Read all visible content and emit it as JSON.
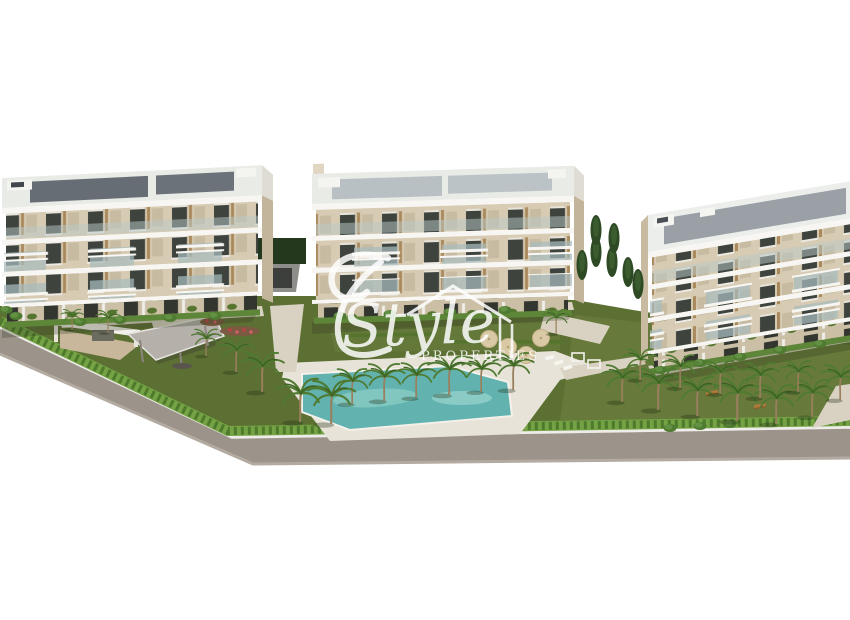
{
  "page": {
    "background": "#ffffff",
    "content_type": "aerial 3D architectural render of a new-build apartment complex with communal pool and palm gardens"
  },
  "watermark": {
    "script_word": "Style",
    "caps_word": "PROPERTIES",
    "house_icon": "house-outline-icon",
    "flourish_icon": "calligraphic-flourish-icon",
    "color": "#ffffff",
    "opacity": "0.85"
  },
  "scene": {
    "buildings": {
      "count": 3,
      "floors_each": 4,
      "style": "modern cream apartment blocks with white balconies and flat roofs"
    },
    "features": [
      "apartment-block-left",
      "apartment-block-center",
      "apartment-block-right",
      "swimming-pool",
      "pool-deck",
      "palm-trees",
      "lawn",
      "perimeter-hedge",
      "road",
      "entrance-gate",
      "parking-ramp",
      "pavilion",
      "sun-umbrellas",
      "sun-loungers",
      "benches",
      "cypress-trees",
      "flower-beds"
    ],
    "colors": {
      "wall_cream": "#d7cbb3",
      "wall_shade": "#c7bba2",
      "trim_white": "#f7f6f2",
      "window_dark": "#3e433d",
      "wood_accent": "#a9895b",
      "roof_panel_dark": "#676d74",
      "roof_panel_light": "#b9c0c4",
      "roof_panel_mid": "#9aa0a6",
      "grass": "#5d7034",
      "grass_light": "#6f8442",
      "hedge": "#74a244",
      "hedge_dark": "#4e7a2c",
      "palm_green": "#4f7a31",
      "palm_trunk": "#9a7f5e",
      "pool_water": "#62b3b0",
      "pool_light": "#a5dad5",
      "deck": "#e8e3d8",
      "path": "#d9d2c2",
      "road": "#9c948b",
      "road_edge": "#b3aba1",
      "curb": "#efede9",
      "umbrella_tan": "#d9c9a4",
      "dark_tree": "#2e4a25",
      "pavilion_roof": "#b5b0aa"
    }
  }
}
